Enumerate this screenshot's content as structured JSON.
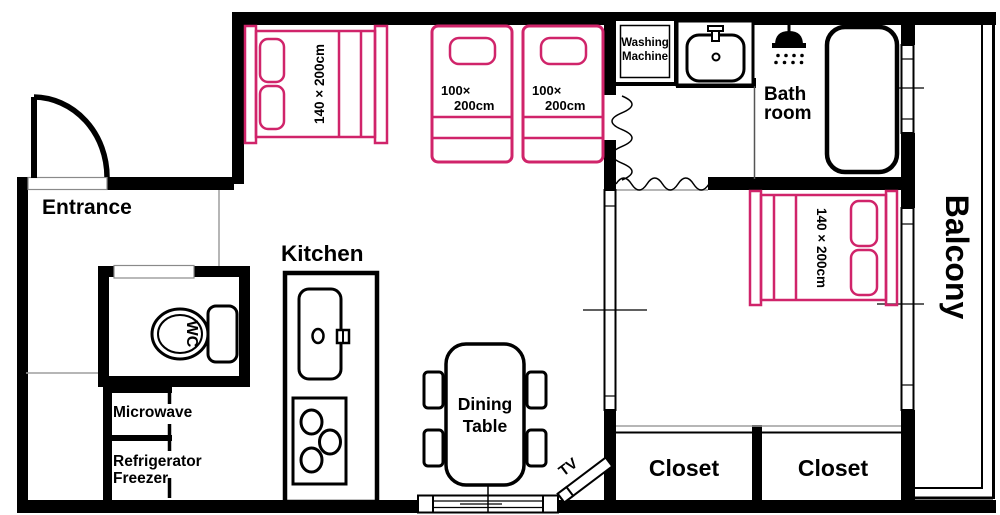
{
  "colors": {
    "wall": "#000000",
    "bed_accent": "#d0246a",
    "guide": "#9e9e9e",
    "background": "#ffffff"
  },
  "rooms": {
    "entrance": "Entrance",
    "kitchen": "Kitchen",
    "bathroom": [
      "Bath",
      "room"
    ],
    "balcony": "Balcony",
    "wc": "WC",
    "closets": [
      "Closet",
      "Closet"
    ]
  },
  "fixtures": {
    "washing_machine": [
      "Washing",
      "Machine"
    ],
    "microwave": "Microwave",
    "refrigerator": [
      "Refrigerator",
      "Freezer"
    ],
    "dining_table": [
      "Dining",
      "Table"
    ],
    "tv": "TV"
  },
  "beds": {
    "double_top": "140 × 200cm",
    "single_left": [
      "100×",
      "200cm"
    ],
    "single_right": [
      "100×",
      "200cm"
    ],
    "double_bedroom": "140 × 200cm"
  }
}
